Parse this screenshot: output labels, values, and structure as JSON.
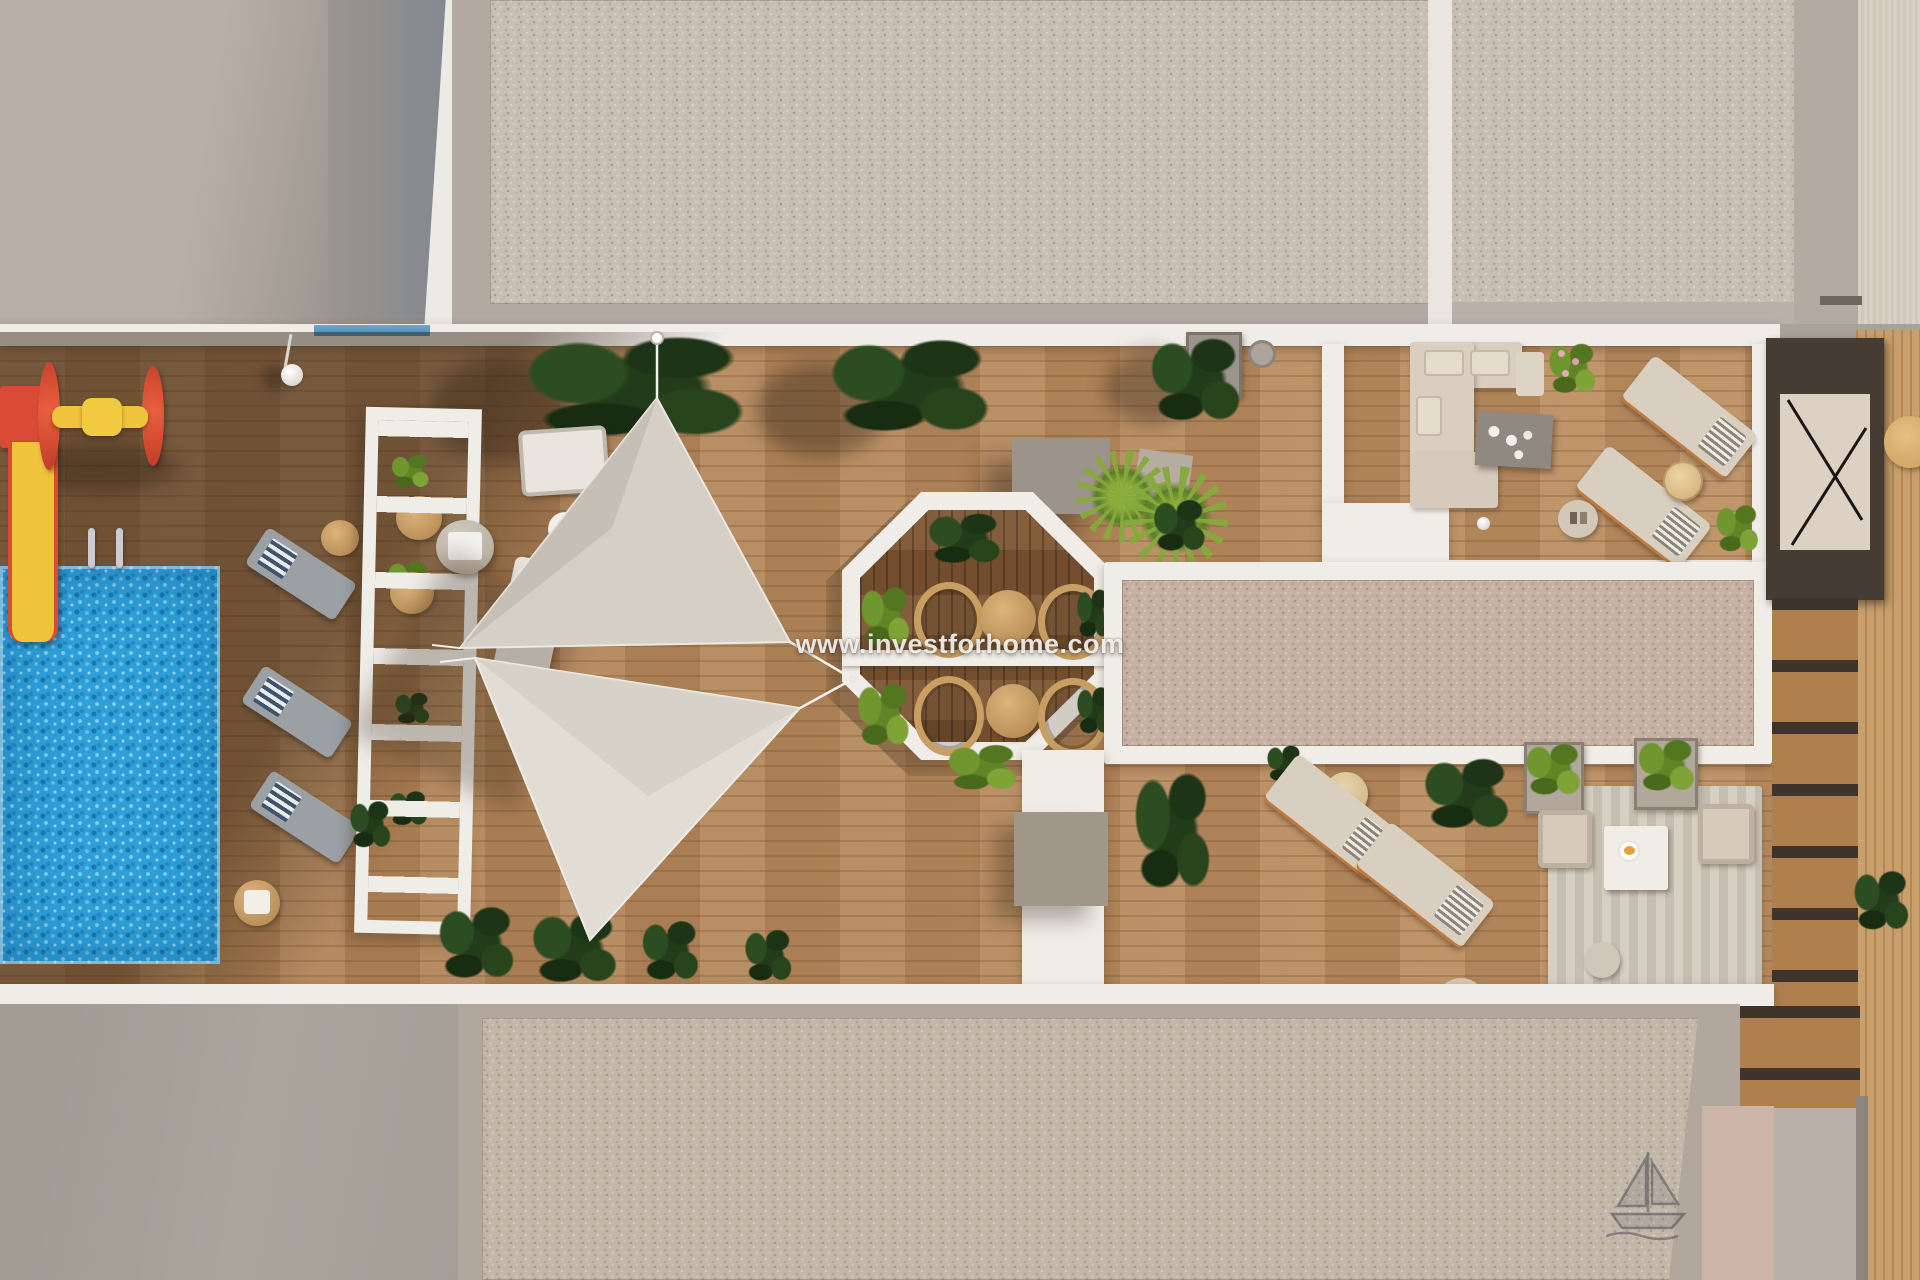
{
  "watermark": {
    "text": "www.investforhome.com"
  },
  "scene": {
    "description": "Aerial top-down 3D architectural rendering of a residential communal rooftop terrace",
    "areas": [
      {
        "id": "swimming-pool",
        "label": "Swimming pool"
      },
      {
        "id": "children-playground",
        "label": "Playground with slide and roller toy"
      },
      {
        "id": "pool-loungers",
        "label": "Poolside sun loungers"
      },
      {
        "id": "white-pergola",
        "label": "White slatted pergola"
      },
      {
        "id": "shade-sails",
        "label": "Triangular shade sails"
      },
      {
        "id": "octagonal-dining",
        "label": "Octagonal dining gazebo with round tables"
      },
      {
        "id": "lounge-sofa",
        "label": "Outdoor lounge with L-shaped sofa"
      },
      {
        "id": "sun-deck",
        "label": "Wooden sun deck with loungers"
      },
      {
        "id": "gravel-roofs",
        "label": "Gravel-covered roof sections"
      },
      {
        "id": "stair-access",
        "label": "Stair access with railing"
      },
      {
        "id": "armchair-lounge",
        "label": "Armchair lounge on striped rug"
      }
    ]
  },
  "palette": {
    "wood_deck": "#b8895b",
    "wood_dark": "#7b5533",
    "gravel": "#c8bfb4",
    "gravel_warm": "#c5b2a4",
    "white_structure": "#f0ede8",
    "pool_blue": "#2f9fd8",
    "sail_gray": "#d5cfc6",
    "plant_dark": "#22391b",
    "plant_light": "#7fa337",
    "accent_red": "#d94b35",
    "accent_yellow": "#f0c33d",
    "concrete_gray": "#b2a9a1"
  }
}
